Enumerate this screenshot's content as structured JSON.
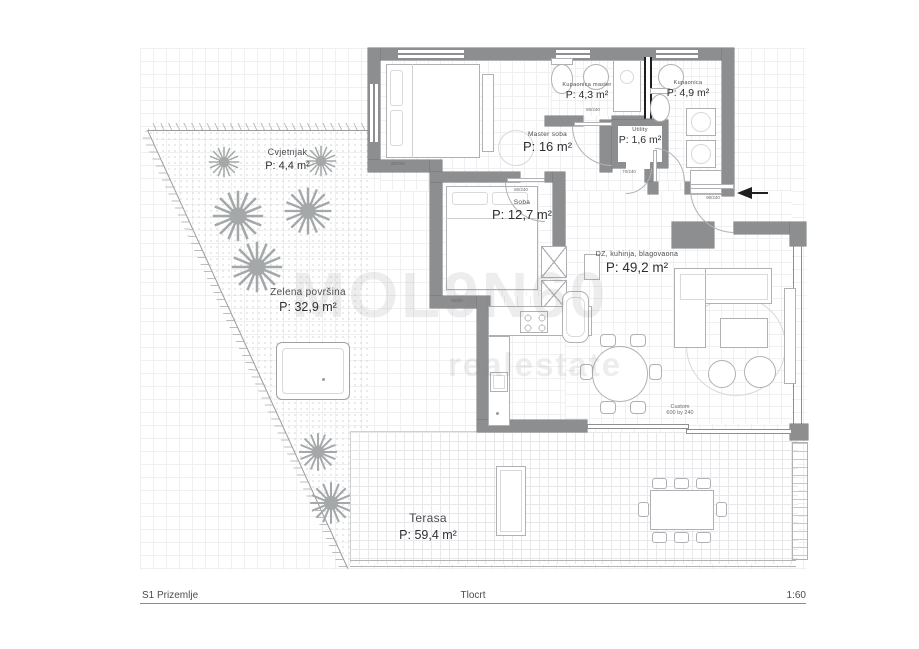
{
  "colors": {
    "wall": "#8d8e90",
    "wall_dark": "#737476",
    "line": "#b0b1b4",
    "line_light": "#d8d9db",
    "grid": "#f0f0f3",
    "text": "#2e2f31",
    "black": "#1f1f1f"
  },
  "title_block": {
    "sheet": "S1 Prizemlje",
    "drawing": "Tlocrt",
    "scale": "1:60"
  },
  "watermark": {
    "line1": "MOL9N60",
    "line2": "realestate"
  },
  "rooms": [
    {
      "id": "cvjetnjak",
      "name": "Cvjetnjak",
      "area": "P: 4,4 m²"
    },
    {
      "id": "zelena_povrsina",
      "name": "Zelena površina",
      "area": "P: 32,9 m²"
    },
    {
      "id": "master_soba",
      "name": "Master soba",
      "area": "P: 16 m²"
    },
    {
      "id": "kupaonica_master",
      "name": "Kupaonica master",
      "area": "P: 4,3 m²"
    },
    {
      "id": "kupaonica",
      "name": "Kupaonica",
      "area": "P: 4,9 m²"
    },
    {
      "id": "utility",
      "name": "Utility",
      "area": "P: 1,6 m²"
    },
    {
      "id": "soba",
      "name": "Soba",
      "area": "P: 12,7 m²"
    },
    {
      "id": "dnevni_boravak",
      "name": "DZ, kuhinja, blagovaona",
      "area": "P: 49,2 m²"
    },
    {
      "id": "terasa",
      "name": "Terasa",
      "area": "P: 59,4 m²"
    }
  ],
  "annotations": {
    "custom_furniture": {
      "label": "Custom",
      "size": "600 by 240"
    },
    "door_tags": [
      "90/240",
      "80/240",
      "80/240",
      "70/240",
      "60/60",
      "80/240"
    ]
  }
}
